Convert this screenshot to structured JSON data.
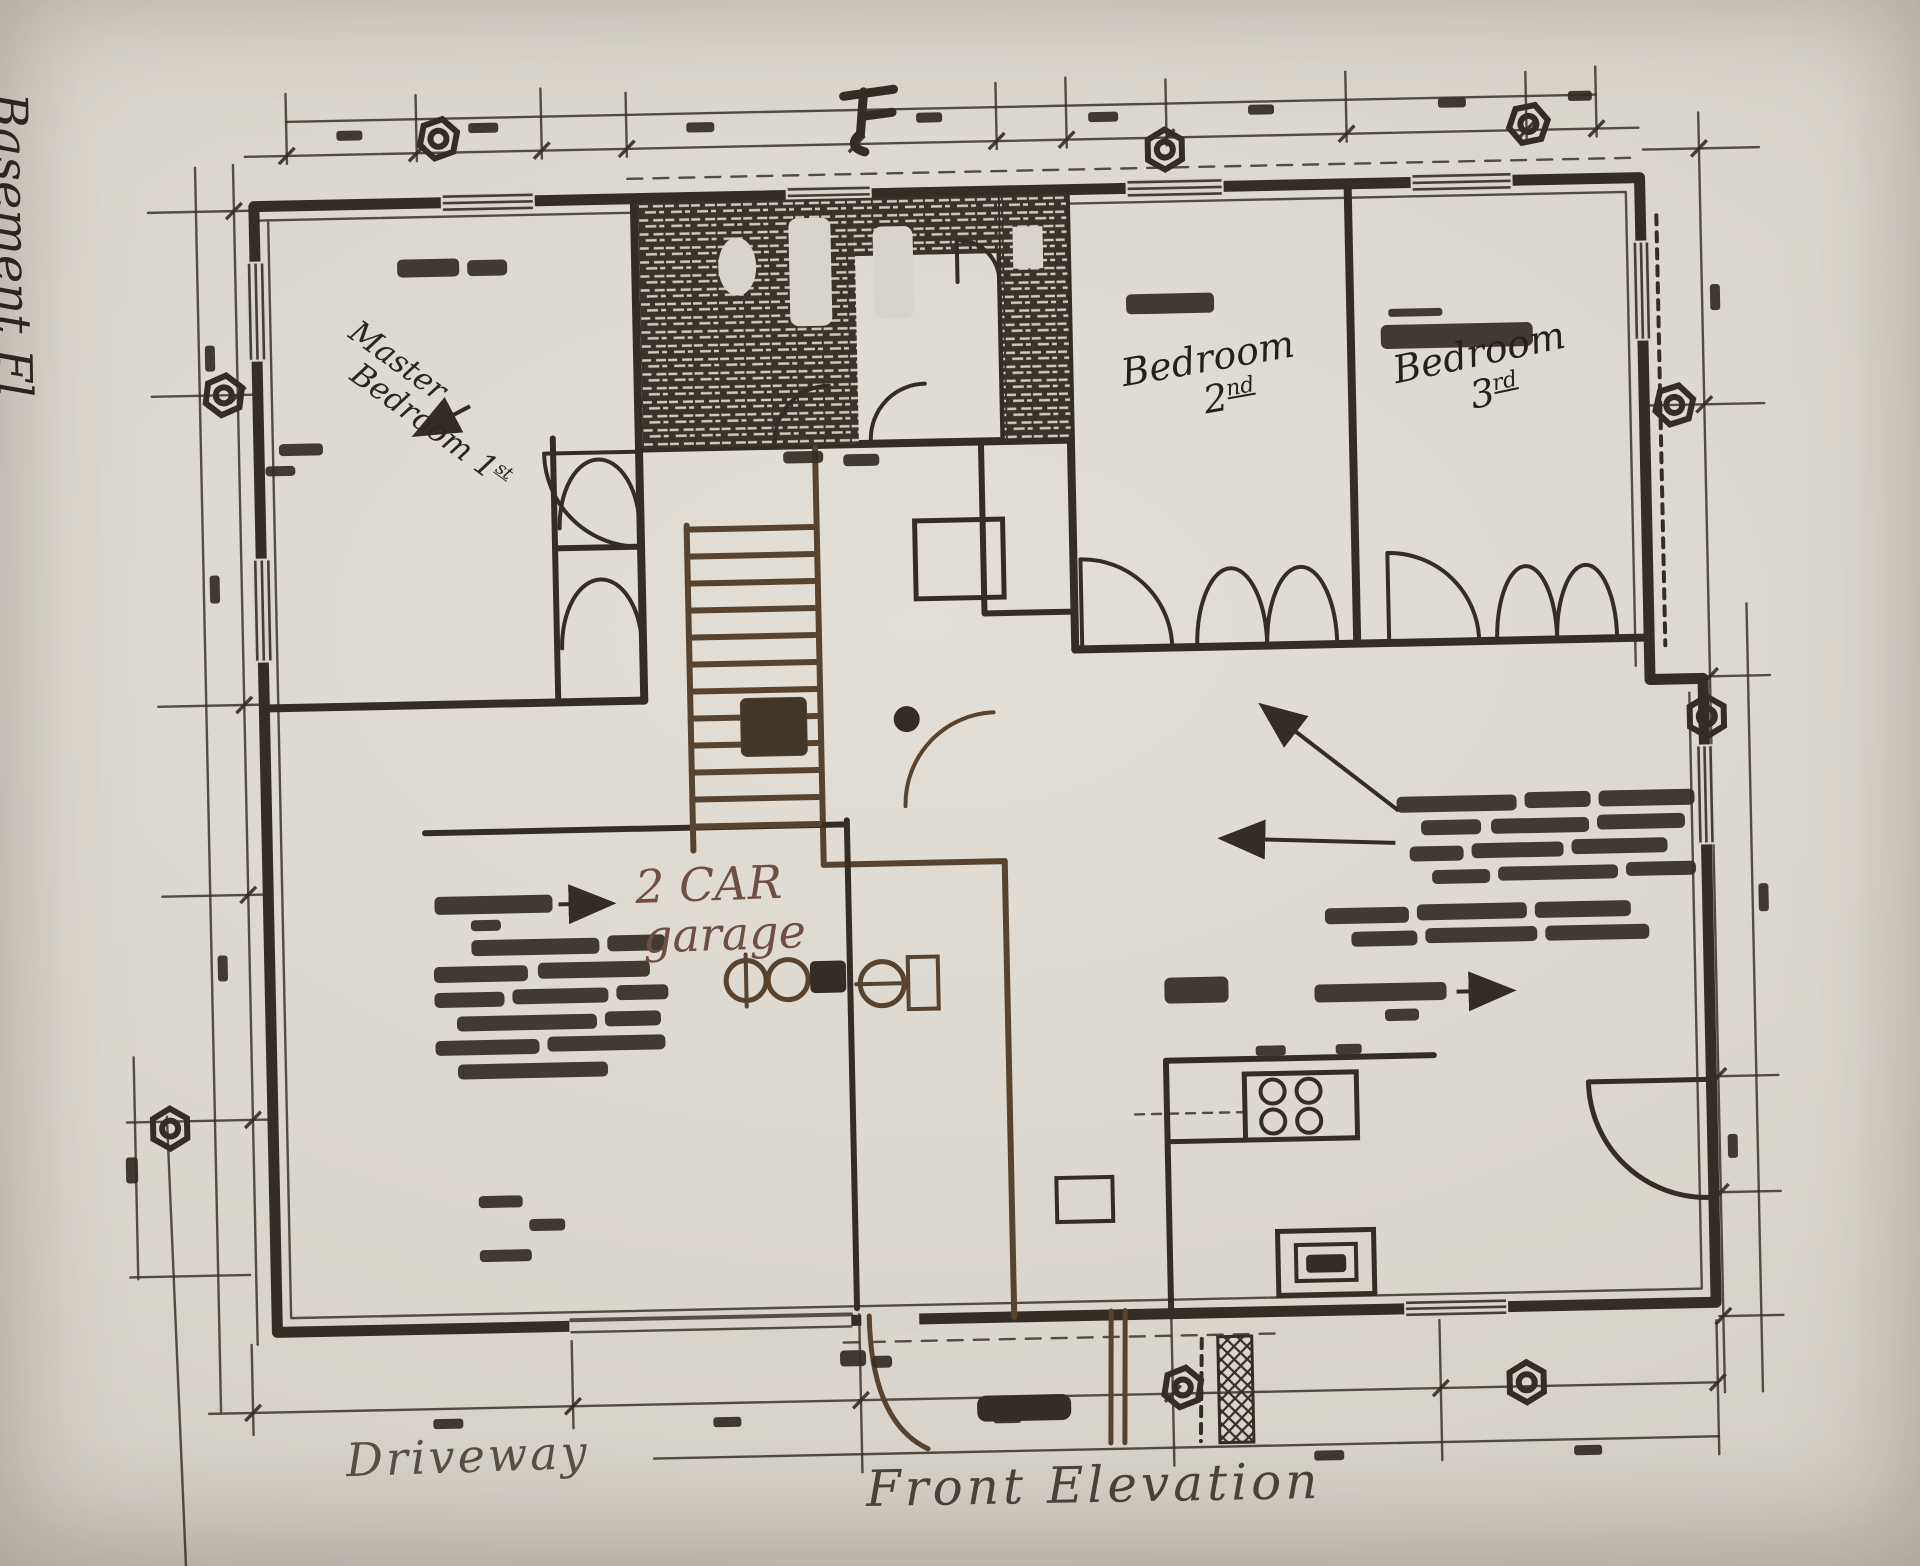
{
  "labels": {
    "basement_side": "Basement Fl",
    "master_line1": "Master",
    "master_line2": "Bedroom",
    "master_num": "1",
    "master_ord": "st",
    "bedroom2_line1": "Bedroom",
    "bedroom2_num": "2",
    "bedroom2_ord": "nd",
    "bedroom3_line1": "Bedroom",
    "bedroom3_num": "3",
    "bedroom3_ord": "rd",
    "garage_line1": "2 CAR",
    "garage_line2": "garage",
    "driveway": "Driveway",
    "front_elevation": "Front Elevation"
  },
  "colors": {
    "paper": "#d9d4cb",
    "ink": "#342d26",
    "faded_ink": "#57432e",
    "garage_ink": "#6f4e43",
    "pencil": "#585148"
  },
  "symbols": {
    "bolt_marker": "hex-nut-icon",
    "north_marker": "section-arrow-icon"
  }
}
